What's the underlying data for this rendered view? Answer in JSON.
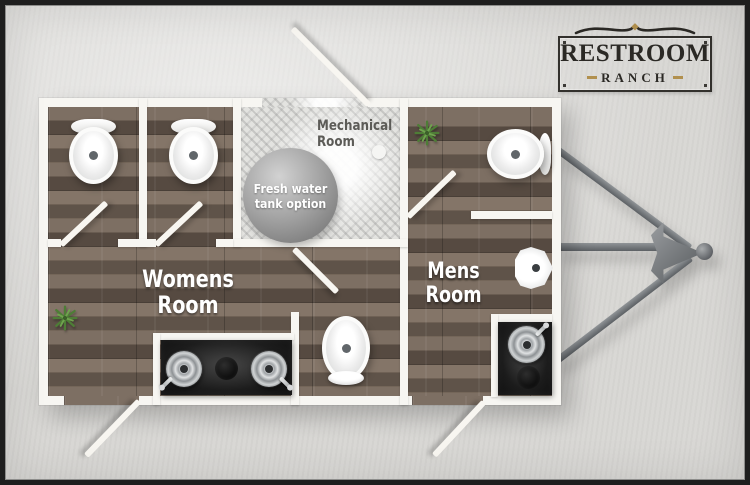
{
  "brand": {
    "line1": "Restroom",
    "line2": "Ranch"
  },
  "rooms": {
    "womens": {
      "label_line1": "Womens",
      "label_line2": "Room"
    },
    "mens": {
      "label_line1": "Mens",
      "label_line2": "Room"
    },
    "mechanical": {
      "label_line1": "Mechanical",
      "label_line2": "Room"
    },
    "tank": {
      "label_line1": "Fresh water",
      "label_line2": "tank option"
    }
  },
  "colors": {
    "background": "#d8d7d4",
    "frame": "#1e1e1e",
    "wall_white": "#f7f6f2",
    "wood_floor": "#6b6055",
    "mechanical_floor": "#e3e3e0",
    "tank_gray": "#9a9a9a",
    "counter_black": "#161616",
    "metal": "#9aa0a3",
    "plant_green": "#4e7d36",
    "label_white": "#ffffff",
    "label_gray": "#5c5b57",
    "logo_ink": "#2b2925",
    "gold_accent": "#b1904e"
  }
}
